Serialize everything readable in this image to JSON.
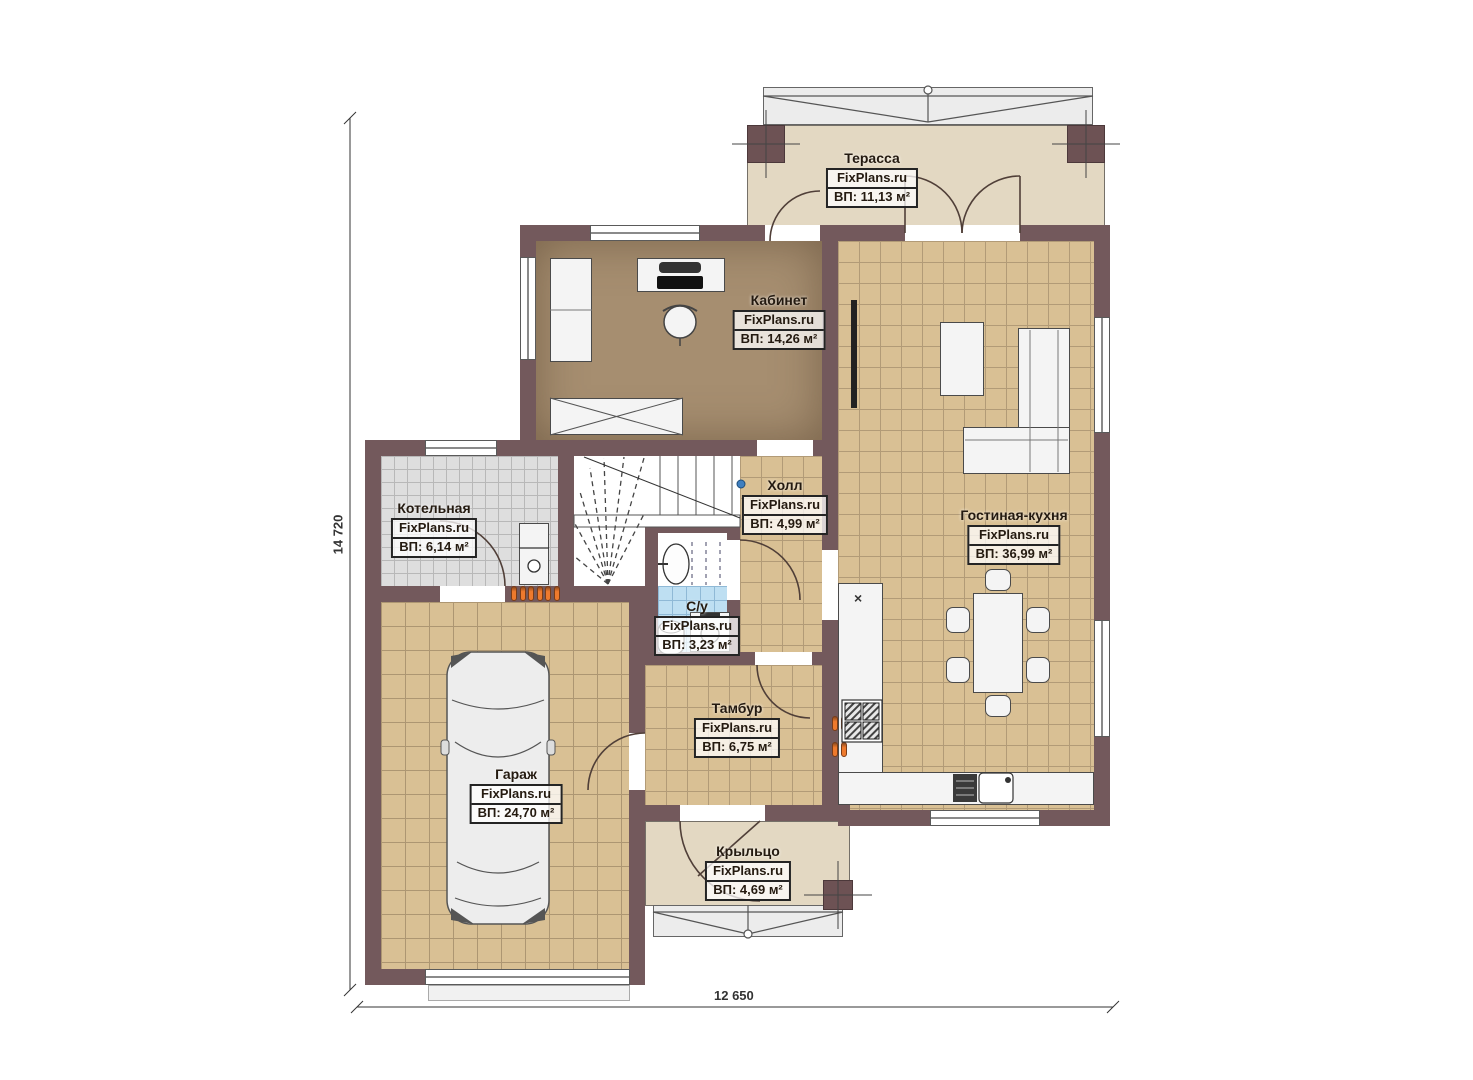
{
  "rooms": [
    {
      "name": "Терасса",
      "watermark": "FixPlans.ru",
      "area": "ВП: 11,13 м²"
    },
    {
      "name": "Кабинет",
      "watermark": "FixPlans.ru",
      "area": "ВП: 14,26 м²"
    },
    {
      "name": "Холл",
      "watermark": "FixPlans.ru",
      "area": "ВП: 4,99 м²"
    },
    {
      "name": "Гостиная-кухня",
      "watermark": "FixPlans.ru",
      "area": "ВП: 36,99 м²"
    },
    {
      "name": "Котельная",
      "watermark": "FixPlans.ru",
      "area": "ВП: 6,14 м²"
    },
    {
      "name": "С/у",
      "watermark": "FixPlans.ru",
      "area": "ВП: 3,23 м²"
    },
    {
      "name": "Тамбур",
      "watermark": "FixPlans.ru",
      "area": "ВП: 6,75 м²"
    },
    {
      "name": "Гараж",
      "watermark": "FixPlans.ru",
      "area": "ВП: 24,70 м²"
    },
    {
      "name": "Крыльцо",
      "watermark": "FixPlans.ru",
      "area": "ВП: 4,69 м²"
    }
  ],
  "dimensions": {
    "height_label": "14 720",
    "width_label": "12 650"
  },
  "symbols": {
    "hob_mark": "×"
  },
  "colors": {
    "wall": "#73595c",
    "terrace_floor": "#e3d8c2",
    "office_floor": "#a68e70",
    "tile_tan": "#d9c094",
    "tile_gray": "#dedede",
    "tile_blue": "#bedff2",
    "canopy": "#ececec",
    "radiator": "#ee7a2d",
    "label_text": "#241a10"
  }
}
